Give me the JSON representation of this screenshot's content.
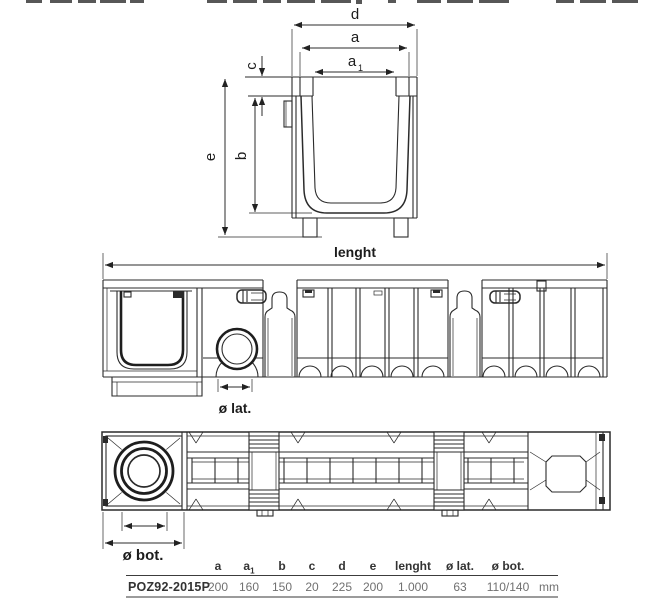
{
  "views": {
    "cross_section": {
      "dim_labels": {
        "d": "d",
        "a": "a",
        "a1_base": "a",
        "a1_sub": "1",
        "c": "c",
        "b": "b",
        "e": "e"
      }
    },
    "side": {
      "length_label": "lenght",
      "lateral_outlet_label": "ø lat."
    },
    "bottom": {
      "bottom_outlet_label": "ø bot."
    }
  },
  "table": {
    "model": "POZ92-2015P",
    "unit": "mm",
    "columns": [
      {
        "header": "a",
        "sub": "",
        "value": "200"
      },
      {
        "header": "a",
        "sub": "1",
        "value": "160"
      },
      {
        "header": "b",
        "sub": "",
        "value": "150"
      },
      {
        "header": "c",
        "sub": "",
        "value": "20"
      },
      {
        "header": "d",
        "sub": "",
        "value": "225"
      },
      {
        "header": "e",
        "sub": "",
        "value": "200"
      },
      {
        "header": "lenght",
        "sub": "",
        "value": "1.000"
      },
      {
        "header": "ø lat.",
        "sub": "",
        "value": "63"
      },
      {
        "header": "ø bot.",
        "sub": "",
        "value": "110/140"
      }
    ]
  },
  "colors": {
    "line": "#2b2b2b",
    "text_dark": "#333333",
    "text_gray": "#707070",
    "rule_gray": "#9b9b9b",
    "background": "#ffffff"
  }
}
